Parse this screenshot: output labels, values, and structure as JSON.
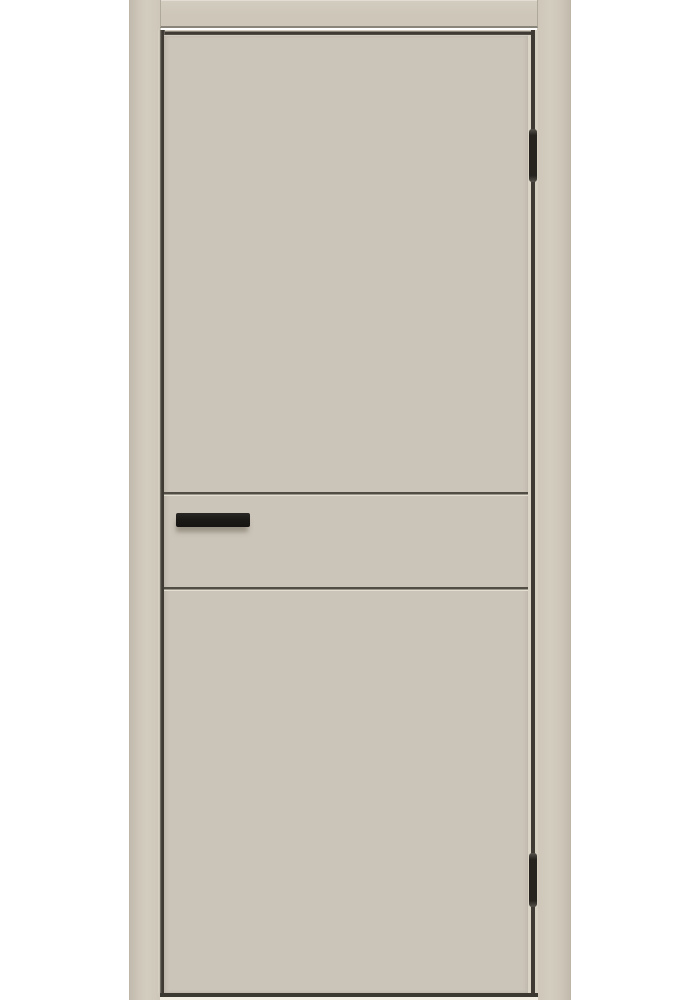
{
  "meta": {
    "description": "Product photograph of a closed beige (greige) flush interior door in a matching door frame on a white background, with two horizontal grooves across the middle, a black bar handle on the left and two black hinges on the right"
  },
  "colors": {
    "background": "#ffffff",
    "frame": "#cdc6b9",
    "frame-edge": "#c2bbad",
    "frame-highlight": "#d3cdc0",
    "head-edge": "#8a857a",
    "leaf": "#cbc4b8",
    "leaf-edge-highlight": "#dad4c7",
    "gap": "#3f3b34",
    "groove": "#514d45",
    "groove-highlight": "#e5dfd2",
    "handle": "#1c1a17",
    "handle-shadow": "rgba(110,103,90,0.55)",
    "hinge": "#26231f",
    "bottom-edge": "#3b3831",
    "bottom-strip": "#f2ede3"
  },
  "door": {
    "type": "flush interior door, closed",
    "groove_count": 2,
    "hinge_count": 2,
    "handle_side": "left",
    "hinge_side": "right"
  }
}
